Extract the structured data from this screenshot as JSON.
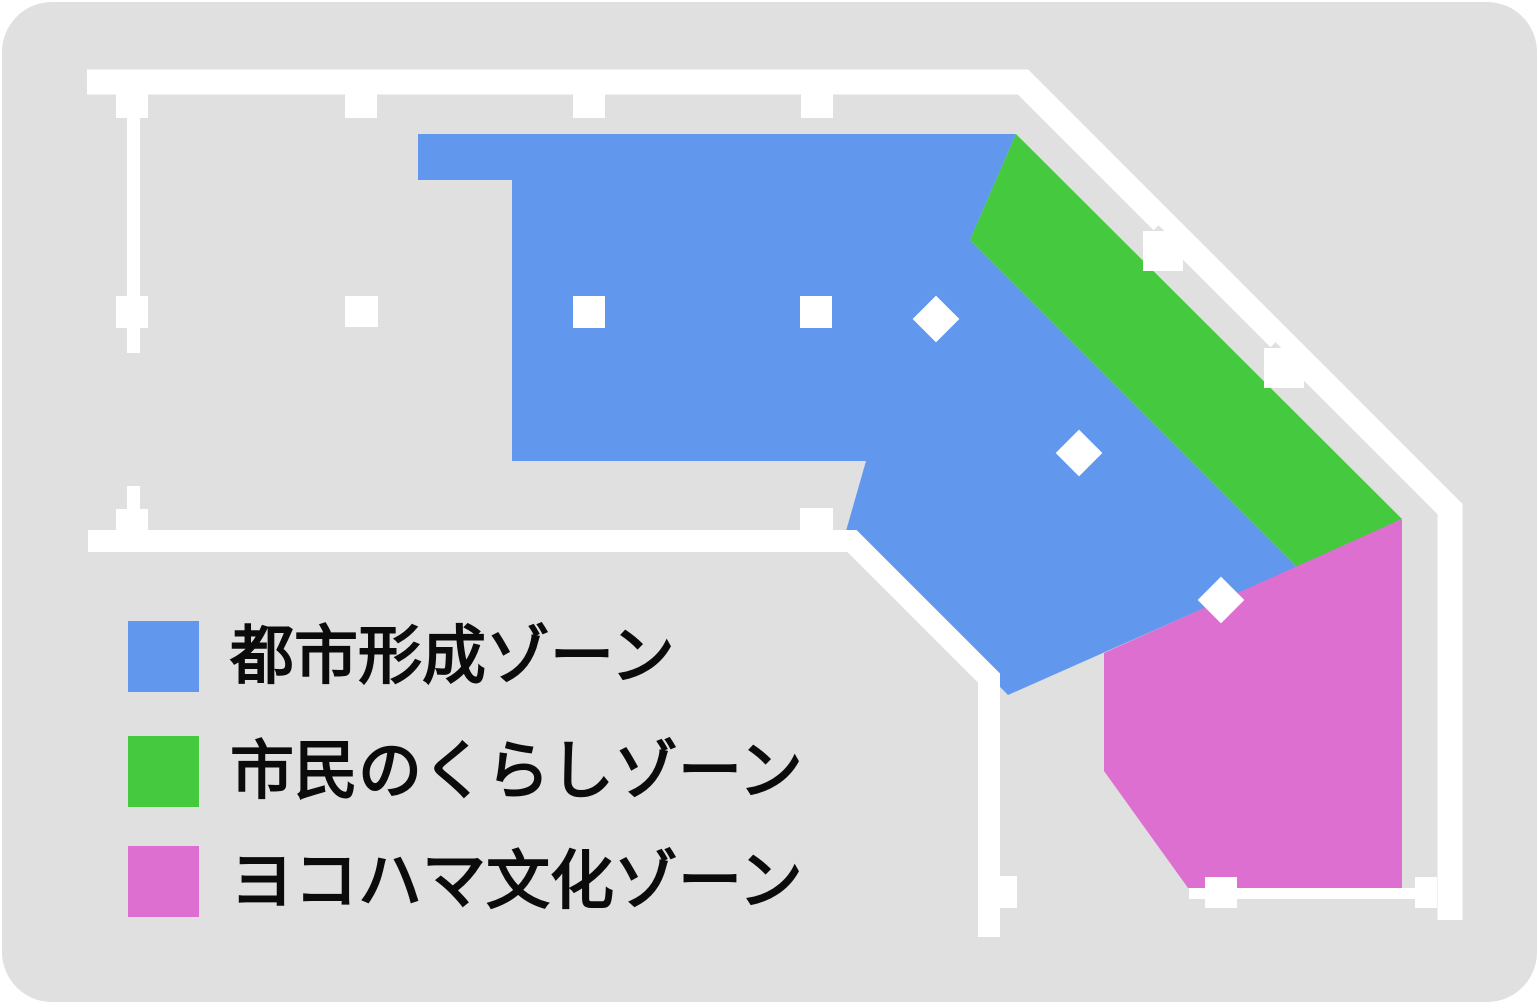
{
  "floor_plan": {
    "floor_color": "#E0E0E0",
    "wall_color": "#FFFFFF",
    "marker_color": "#FFFFFF",
    "page_background": "#FFFFFF"
  },
  "zones": [
    {
      "id": "urban-formation",
      "label": "都市形成ゾーン",
      "color": "#6297EE"
    },
    {
      "id": "citizens-life",
      "label": "市民のくらしゾーン",
      "color": "#45C93E"
    },
    {
      "id": "yokohama-culture",
      "label": "ヨコハマ文化ゾーン",
      "color": "#DC6FD0"
    }
  ]
}
